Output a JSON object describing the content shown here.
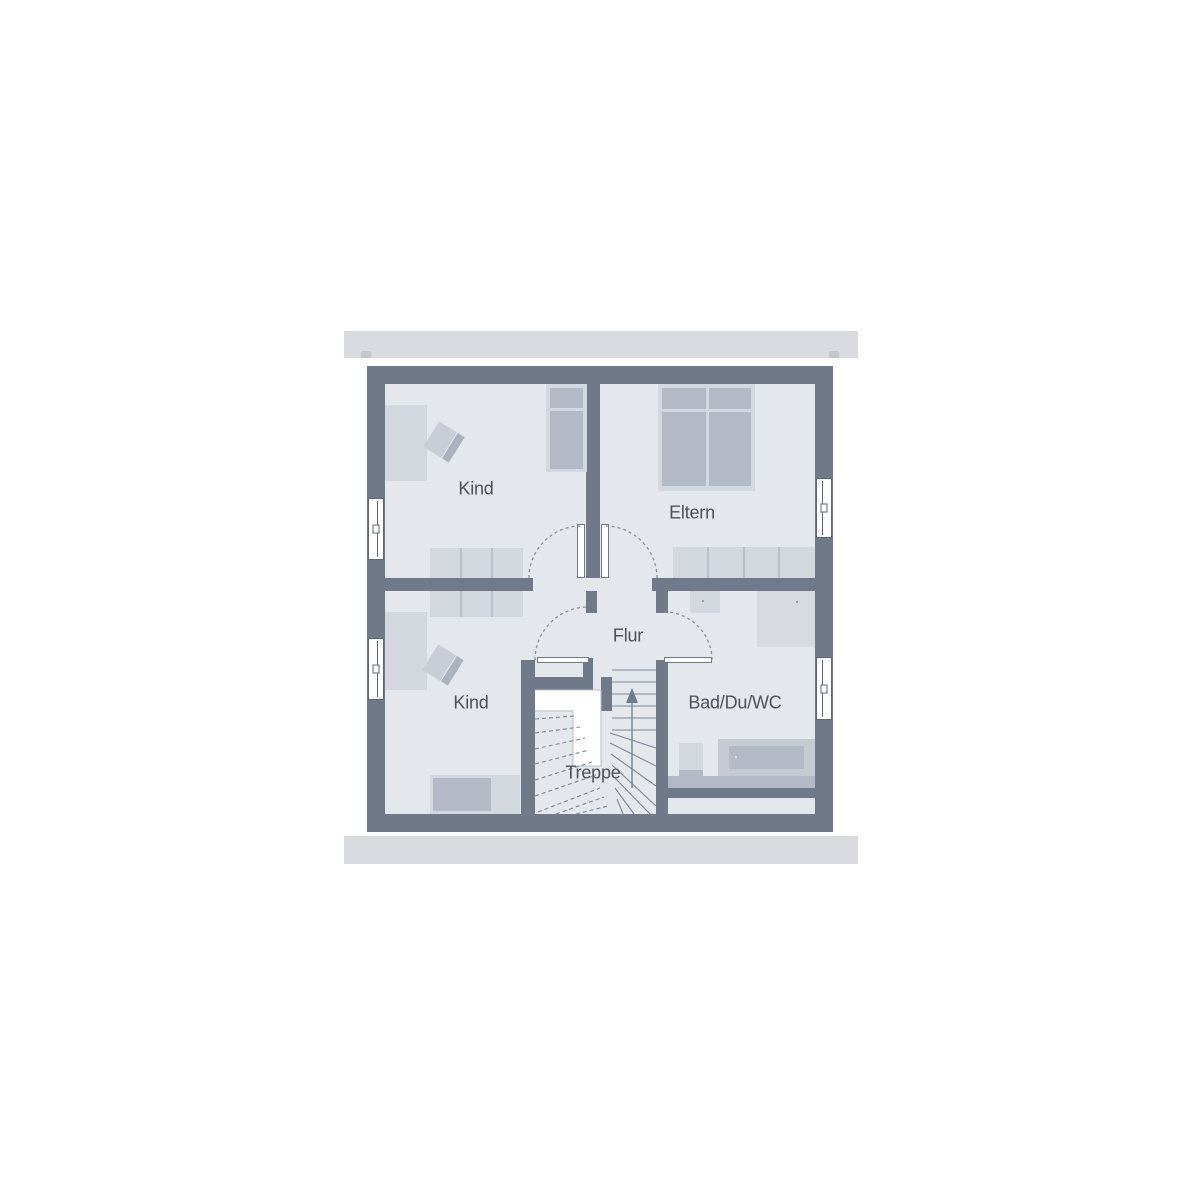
{
  "plan": {
    "title": "Dachgeschoss Grundriss",
    "rooms": [
      {
        "id": "kind-top",
        "label": "Kind"
      },
      {
        "id": "eltern",
        "label": "Eltern"
      },
      {
        "id": "kind-bottom",
        "label": "Kind"
      },
      {
        "id": "flur",
        "label": "Flur"
      },
      {
        "id": "stairs",
        "label": "Treppe"
      },
      {
        "id": "bath",
        "label": "Bad/Du/WC"
      }
    ],
    "stairs": {
      "direction_icon": "arrow-up"
    },
    "colors": {
      "background": "#ffffff",
      "wall": "#6f7989",
      "floor": "#e4e7ec",
      "roof_band": "#d9dbe0",
      "furniture_light": "#d3d7de",
      "furniture_medium": "#b4bac5",
      "shower": "#d7dade",
      "door_arc": "#8992a0",
      "stair_line": "#7e8795",
      "label_text": "#4d525a"
    }
  }
}
